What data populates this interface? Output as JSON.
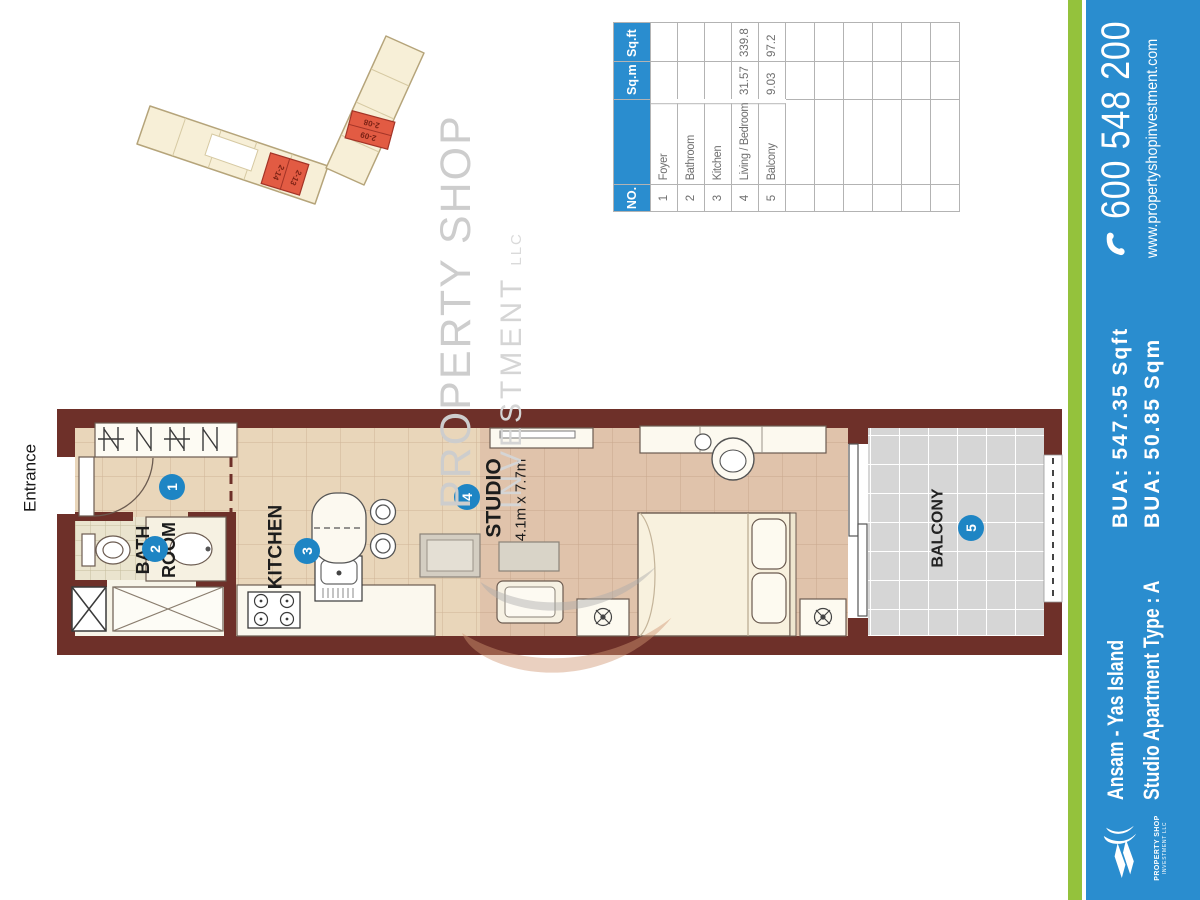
{
  "colors": {
    "accent_blue": "#2a8dcf",
    "accent_green": "#94c23c",
    "wall_maroon": "#6e3029",
    "marker_blue": "#1e85c4",
    "highlight_red": "#e25b43",
    "floor_tan": "#e0c3ab",
    "balcony_grey": "#d6d6d6"
  },
  "site_plan": {
    "units": [
      "2-08",
      "2-09",
      "2-14",
      "2-13"
    ]
  },
  "floor_plan": {
    "entrance": "Entrance",
    "bath_line1": "BATH",
    "bath_line2": "ROOM",
    "kitchen": "KITCHEN",
    "studio": "STUDIO",
    "studio_dims": "4.1m x 7.7m",
    "balcony": "BALCONY",
    "markers": {
      "foyer": "1",
      "bathroom": "2",
      "kitchen": "3",
      "studio": "4",
      "balcony": "5"
    }
  },
  "area_table": {
    "headers": {
      "no": "NO.",
      "name": "",
      "sqm": "Sq.m",
      "sqft": "Sq.ft"
    },
    "rows": [
      {
        "no": "1",
        "name": "Foyer",
        "sqm": "",
        "sqft": ""
      },
      {
        "no": "2",
        "name": "Bathroom",
        "sqm": "",
        "sqft": ""
      },
      {
        "no": "3",
        "name": "Kitchen",
        "sqm": "",
        "sqft": ""
      },
      {
        "no": "4",
        "name": "Living / Bedroom",
        "sqm": "31.57",
        "sqft": "339.8"
      },
      {
        "no": "5",
        "name": "Balcony",
        "sqm": "9.03",
        "sqft": "97.2"
      }
    ],
    "empty_row_count": 6
  },
  "watermark": {
    "line1": "PROPERTY SHOP",
    "line2": "INVESTMENT",
    "line2_suffix": "LLC"
  },
  "footer": {
    "logo_line1": "PROPERTY SHOP",
    "logo_line2": "INVESTMENT LLC",
    "project": "Ansam - Yas Island",
    "unit_type": "Studio Apartment Type : A",
    "bua_sqft": "BUA: 547.35 Sqft",
    "bua_sqm": "BUA: 50.85 Sqm",
    "phone": "600 548 200",
    "website": "www.propertyshopinvestment.com"
  }
}
